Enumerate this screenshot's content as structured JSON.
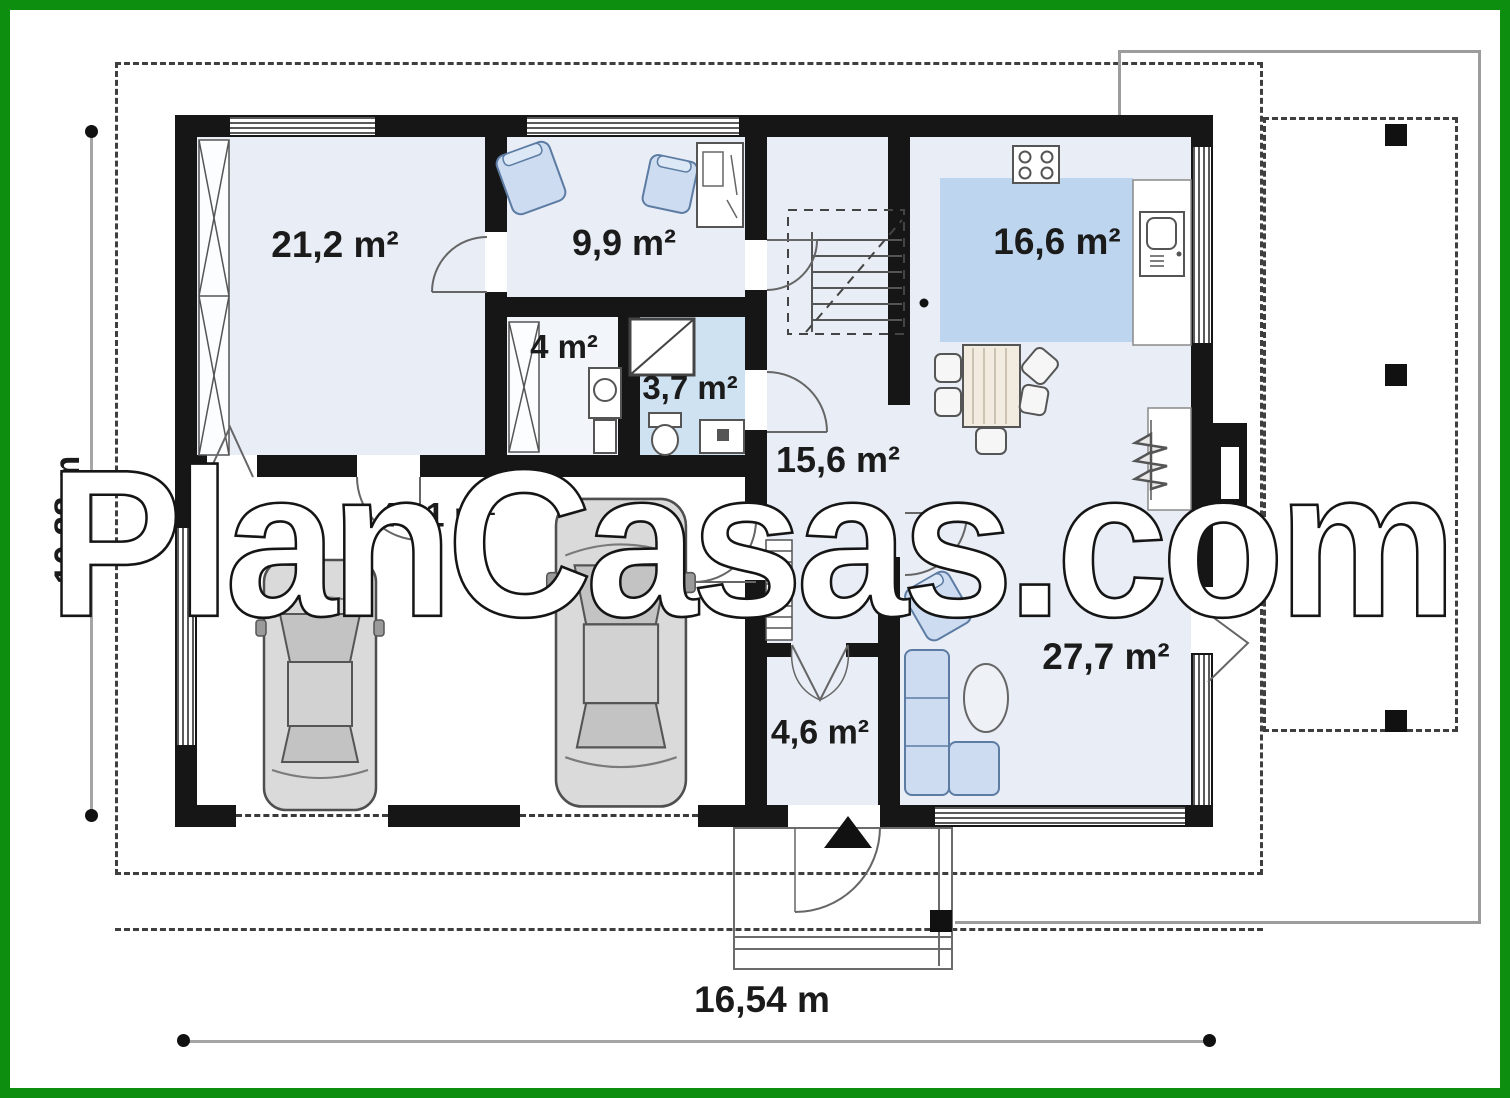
{
  "title": "Single storey house floor plan",
  "watermark": "PlanCasas.com",
  "dimensions": {
    "width_label": "16,54 m",
    "height_label": "10,88 m"
  },
  "rooms": [
    {
      "id": "bedroom",
      "label": "21,2 m²"
    },
    {
      "id": "study",
      "label": "9,9 m²"
    },
    {
      "id": "wardrobe",
      "label": "4 m²"
    },
    {
      "id": "bathroom",
      "label": "3,7 m²"
    },
    {
      "id": "hall",
      "label": "15,6 m²"
    },
    {
      "id": "kitchen",
      "label": "16,6 m²"
    },
    {
      "id": "garage",
      "label": "43,1 m²"
    },
    {
      "id": "living-room",
      "label": "27,7 m²"
    },
    {
      "id": "entry",
      "label": "4,6 m²"
    }
  ],
  "colors": {
    "frame_green": "#0e8e0e",
    "wall_black": "#161616",
    "room_fill": "#e8edf6",
    "bath_fill": "#cfe2f2",
    "kitchen_island_fill": "#bdd5ee",
    "furniture_blue": "#cddcf0",
    "watermark_fill": "#ffffff"
  },
  "icons": [
    "car-icon",
    "car-icon",
    "sofa-icon",
    "armchair-icon",
    "armchair-icon",
    "armchair-icon",
    "oval-table-icon",
    "dining-table-icon",
    "chair-icon",
    "stove-icon",
    "sink-icon",
    "counter-icon",
    "shower-icon",
    "washbasin-icon",
    "toilet-icon",
    "washing-machine-icon",
    "wardrobe-icon",
    "wardrobe-icon",
    "stairs-icon",
    "radiator-icon",
    "radiator-icon",
    "door-swing-icon",
    "entrance-arrow-icon",
    "terrace-post-icon"
  ]
}
